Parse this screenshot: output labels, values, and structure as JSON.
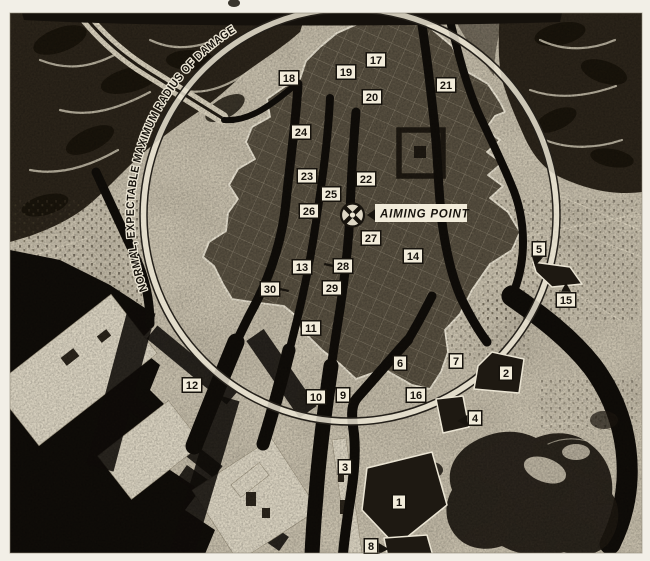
{
  "map": {
    "circle_label": "NORMAL, EXPECTABLE MAXIMUM RADIUS OF DAMAGE",
    "aiming_point": {
      "label": "AIMING POINT",
      "x": 352,
      "y": 215
    },
    "damage_circle": {
      "cx": 350,
      "cy": 215,
      "r": 206
    },
    "markers": [
      {
        "label": "1",
        "x": 399,
        "y": 502
      },
      {
        "label": "2",
        "x": 506,
        "y": 373
      },
      {
        "label": "3",
        "x": 345,
        "y": 467
      },
      {
        "label": "4",
        "x": 475,
        "y": 418,
        "tail": "left-arrow"
      },
      {
        "label": "5",
        "x": 539,
        "y": 249,
        "tail": "down-arrow"
      },
      {
        "label": "6",
        "x": 400,
        "y": 363
      },
      {
        "label": "7",
        "x": 456,
        "y": 361
      },
      {
        "label": "8",
        "x": 371,
        "y": 546,
        "tail": "right-arrow"
      },
      {
        "label": "9",
        "x": 343,
        "y": 395
      },
      {
        "label": "10",
        "x": 316,
        "y": 397
      },
      {
        "label": "11",
        "x": 311,
        "y": 328
      },
      {
        "label": "12",
        "x": 192,
        "y": 385
      },
      {
        "label": "13",
        "x": 302,
        "y": 267
      },
      {
        "label": "14",
        "x": 413,
        "y": 256
      },
      {
        "label": "15",
        "x": 566,
        "y": 300,
        "tail": "up-arrow"
      },
      {
        "label": "16",
        "x": 416,
        "y": 395
      },
      {
        "label": "17",
        "x": 376,
        "y": 60
      },
      {
        "label": "18",
        "x": 289,
        "y": 78
      },
      {
        "label": "19",
        "x": 346,
        "y": 72
      },
      {
        "label": "20",
        "x": 372,
        "y": 97
      },
      {
        "label": "21",
        "x": 446,
        "y": 85
      },
      {
        "label": "22",
        "x": 366,
        "y": 179
      },
      {
        "label": "23",
        "x": 307,
        "y": 176
      },
      {
        "label": "24",
        "x": 301,
        "y": 132
      },
      {
        "label": "25",
        "x": 331,
        "y": 194
      },
      {
        "label": "26",
        "x": 309,
        "y": 211
      },
      {
        "label": "27",
        "x": 371,
        "y": 238
      },
      {
        "label": "28",
        "x": 343,
        "y": 266,
        "tail": "left-line"
      },
      {
        "label": "29",
        "x": 332,
        "y": 288
      },
      {
        "label": "30",
        "x": 270,
        "y": 289,
        "tail": "right-line"
      }
    ]
  },
  "palette": {
    "paper": "#f2efe7",
    "photo_light": "#c8c0ad",
    "lowland_light": "#d8d1bf",
    "mountain": "#2b241a",
    "ridge": "#d6ceba",
    "water": "#100d09",
    "city": "#564e3f",
    "outline": "#ebe5d4",
    "ink": "#17130d",
    "label_bg": "#f2ecdb",
    "road": "#dad2be",
    "blackpoly": "#1e1912"
  }
}
